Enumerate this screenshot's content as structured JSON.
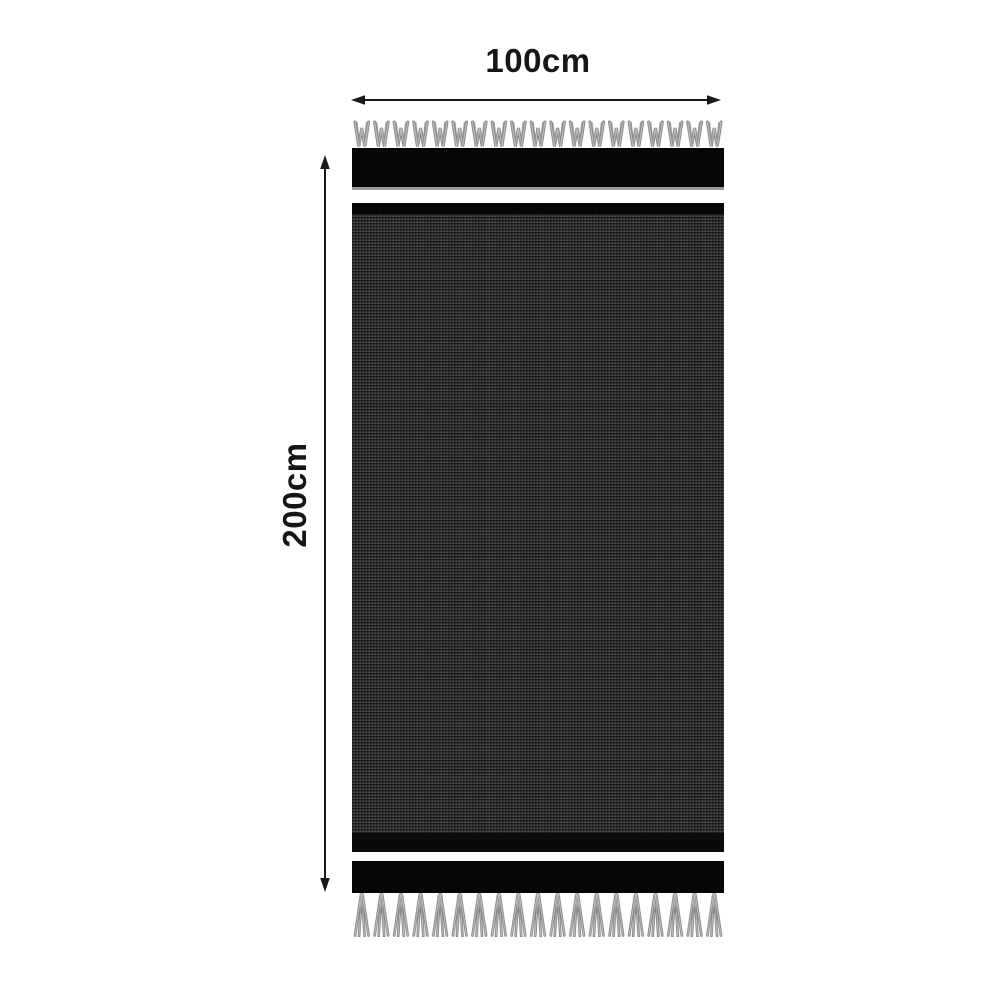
{
  "diagram": {
    "width_label": "100cm",
    "height_label": "200cm"
  },
  "colors": {
    "background": "#ffffff",
    "band": "#060606",
    "band_underline": "#9a9a9a",
    "fabric_base": "#303030",
    "fringe": "#8f8f8f",
    "text": "#161616",
    "arrow": "#1a1a1a"
  },
  "icons": {
    "width_arrow": "double-headed-horizontal-arrow",
    "height_arrow": "double-headed-vertical-arrow"
  }
}
